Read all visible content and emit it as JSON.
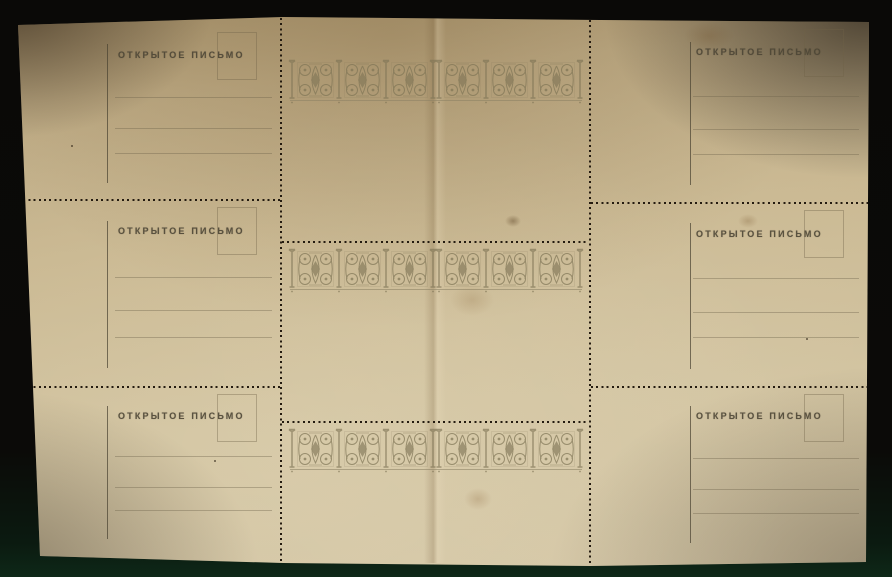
{
  "scene": {
    "background_color": "#0a0907",
    "background_bottom_tint": "#0e2818"
  },
  "sheet": {
    "grid": {
      "rows": 3,
      "columns": 3
    },
    "paper_color": "#c8b58e",
    "perforation_color": "#241b10",
    "ink_color": "#4d4636",
    "ornament_color": "#7f7556",
    "rule_color": "#8d8165"
  },
  "postcard_back": {
    "title": "ОТКРЫТОЕ ПИСЬМО"
  },
  "postcard_front": {
    "ornament_icon": "scroll-and-lozenge-frieze-icon"
  }
}
